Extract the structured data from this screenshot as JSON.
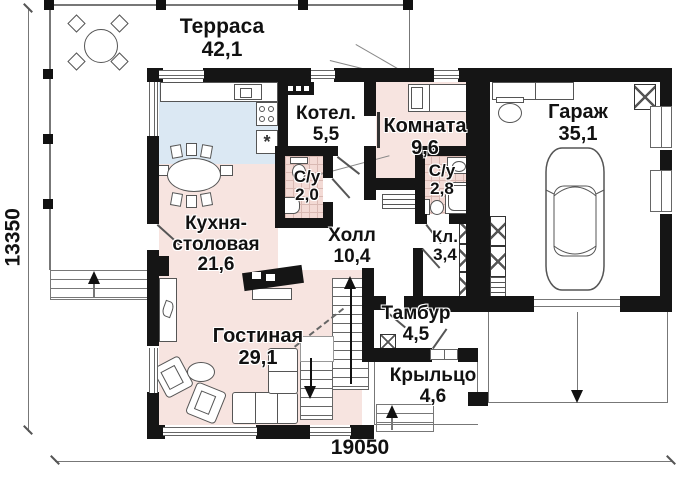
{
  "plan": {
    "rooms": [
      {
        "name": "Терраса",
        "area": "42,1"
      },
      {
        "name": "Котел.",
        "area": "5,5"
      },
      {
        "name": "Комната",
        "area": "9,6"
      },
      {
        "name": "Гараж",
        "area": "35,1"
      },
      {
        "name": "С/у",
        "area": "2,0"
      },
      {
        "name": "С/у",
        "area": "2,8"
      },
      {
        "name": "Кухня-столовая",
        "area": "21,6"
      },
      {
        "name": "Холл",
        "area": "10,4"
      },
      {
        "name": "Кл.",
        "area": "3,4"
      },
      {
        "name": "Гостиная",
        "area": "29,1"
      },
      {
        "name": "Тамбур",
        "area": "4,5"
      },
      {
        "name": "Крыльцо",
        "area": "4,6"
      }
    ],
    "dimensions": {
      "height_label": "13350",
      "width_label": "19050"
    },
    "symbols": {
      "appliance_star": "*"
    },
    "colors": {
      "wall": "#151515",
      "floor_pink": "#f7e4e0",
      "floor_blue": "#dbe8f3",
      "tile_pink": "#f3dad5",
      "line": "#777777"
    }
  }
}
